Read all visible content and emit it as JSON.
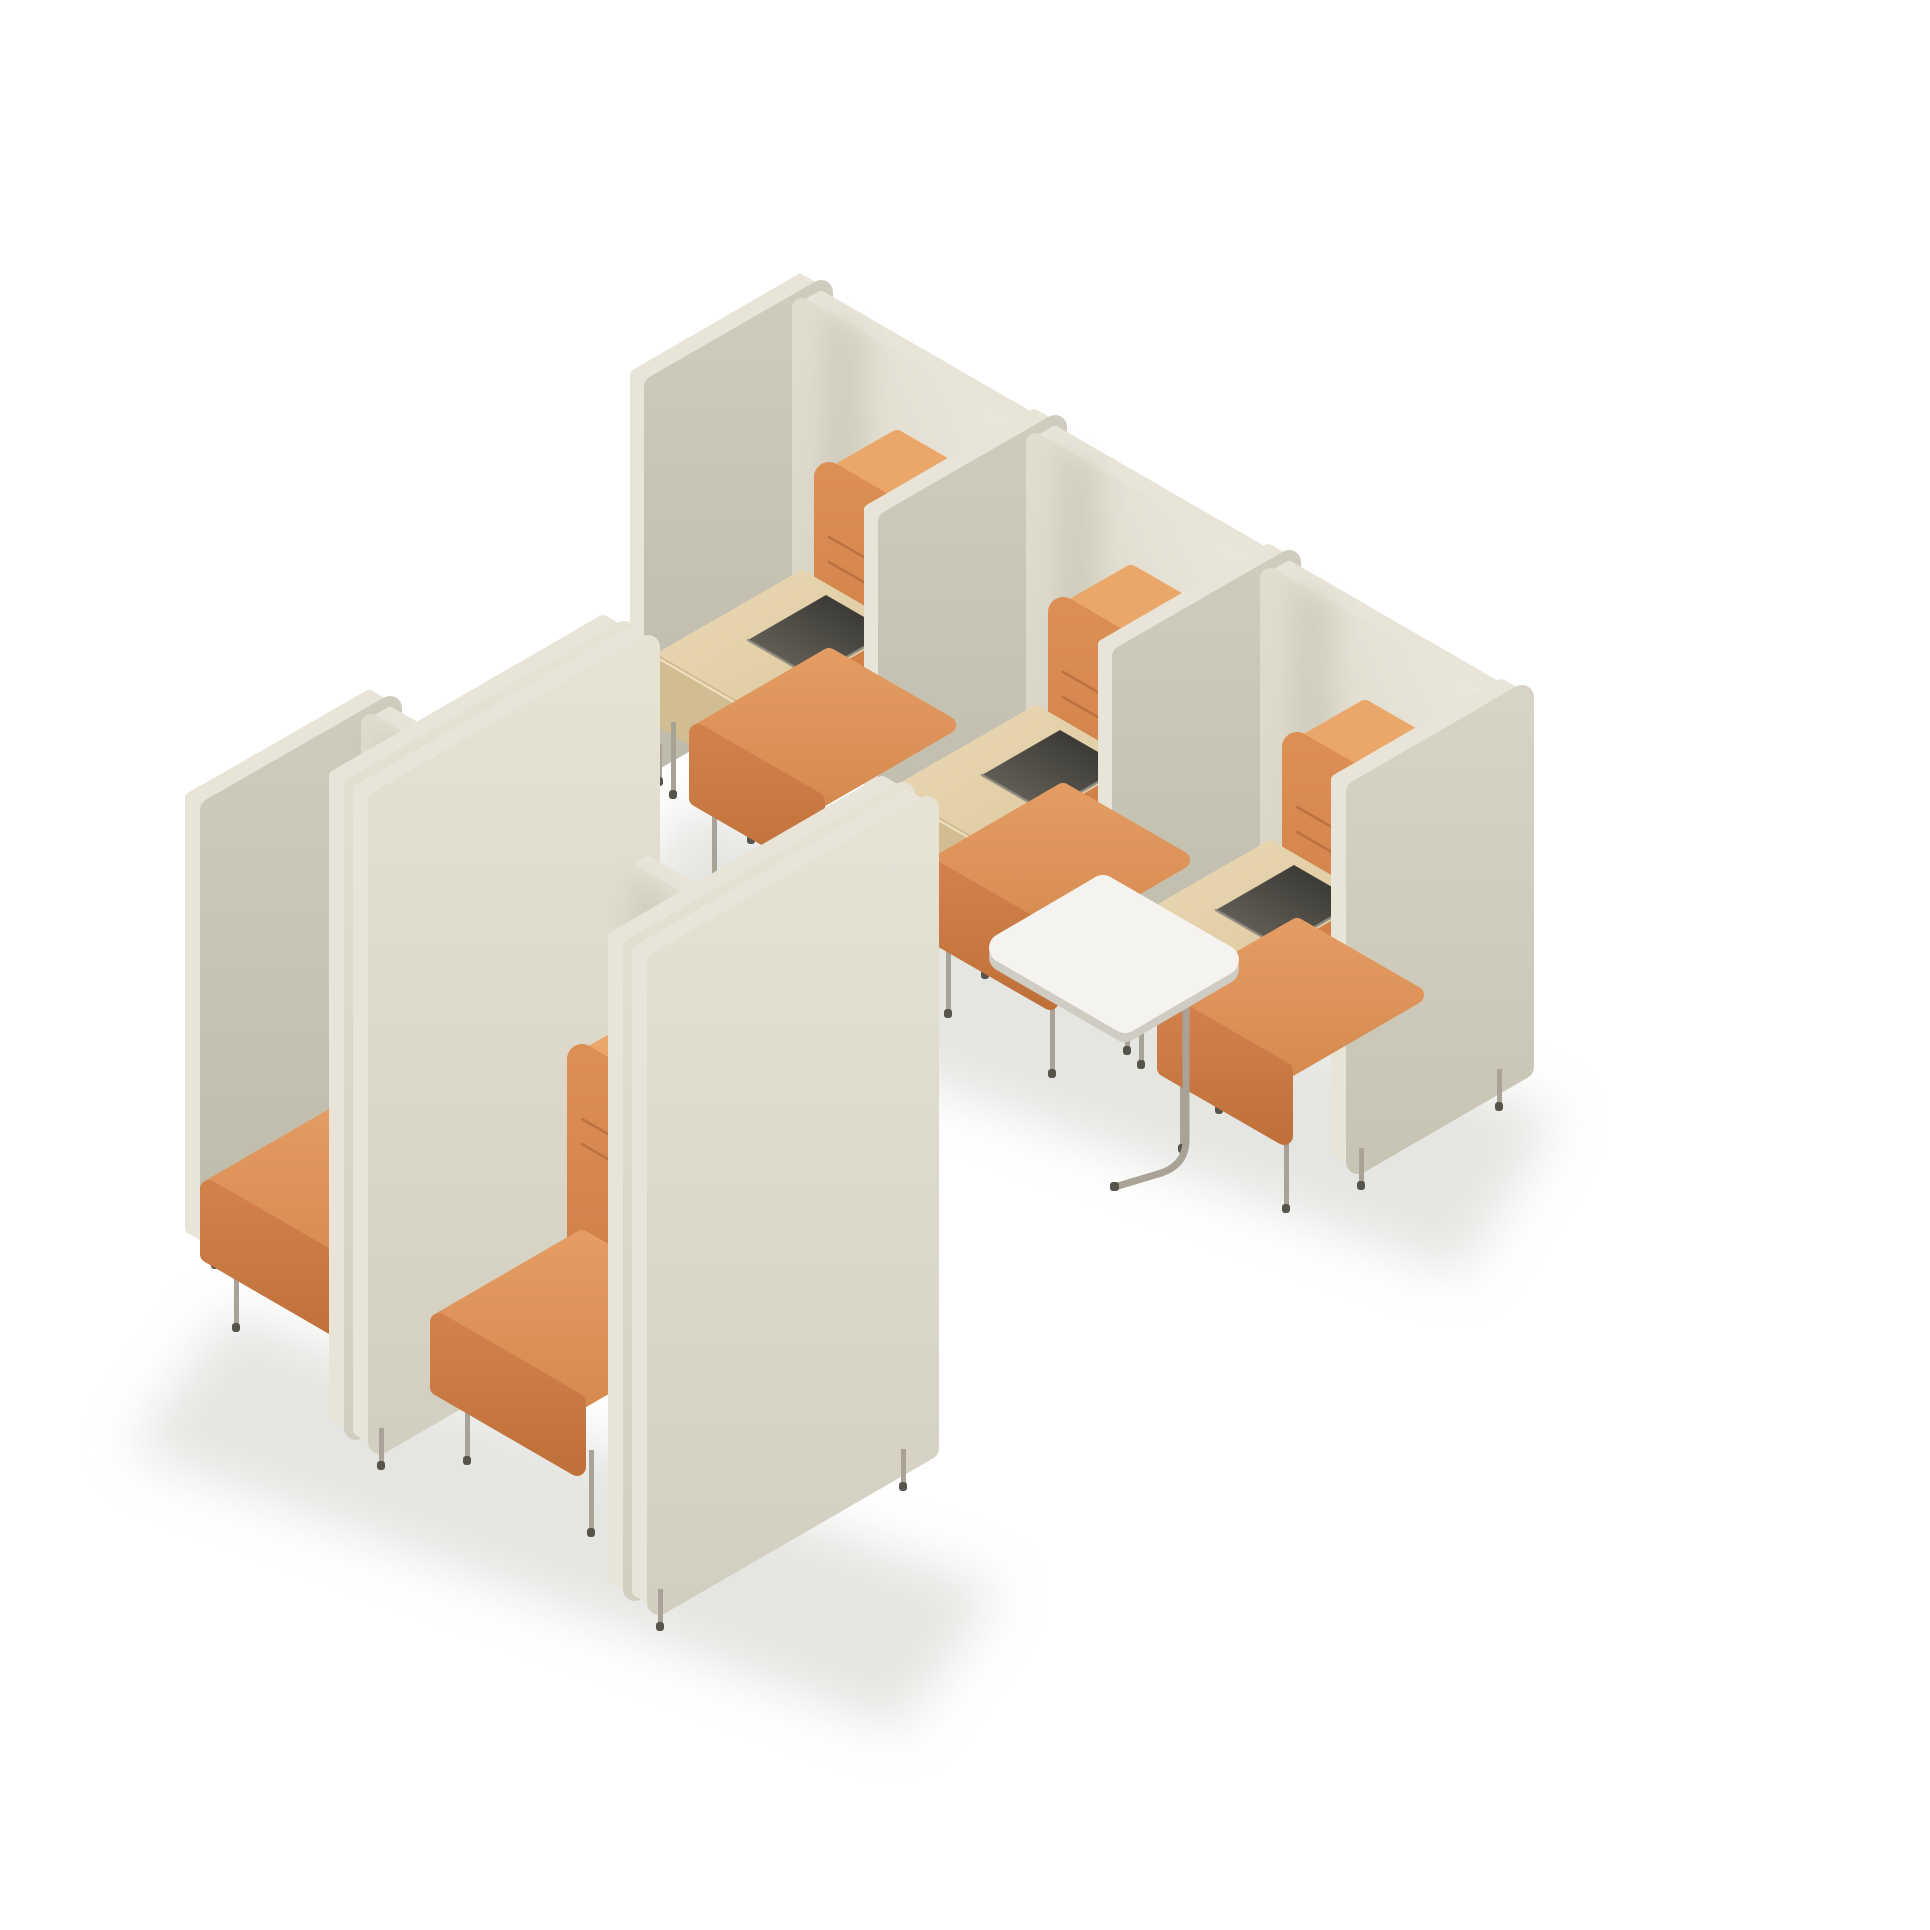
{
  "canvas": {
    "width": 1930,
    "height": 1930,
    "background": "#ffffff"
  },
  "scene": {
    "type": "isometric 3D product render",
    "subject": "modular acoustic privacy seating booths with high screens",
    "floor": "white studio background with soft cast shadows",
    "groups": [
      {
        "id": "booth-row-top-right",
        "booth_count": 3,
        "orientation": "row running to lower-right, seats opening toward lower-left",
        "booths": [
          {
            "id": "booth-1",
            "seat": "single orange fabric seat with channel-stitched backrest",
            "side_table": "light oak bench table",
            "storage_tray": "black recessed tray",
            "panels": "greige upholstered privacy panels with light welt edges",
            "legs": "thin tan metal legs"
          },
          {
            "id": "booth-2",
            "seat": "single orange fabric seat with channel-stitched backrest",
            "side_table": "light oak bench table",
            "storage_tray": "black recessed tray",
            "panels": "greige upholstered privacy panels with light welt edges",
            "legs": "thin tan metal legs"
          },
          {
            "id": "booth-3",
            "seat": "single orange fabric seat with channel-stitched backrest",
            "side_table": "light oak bench table",
            "storage_tray": "black recessed tray",
            "tablet_table": "white rounded-rectangle side table on metal sled base",
            "panels": "greige upholstered privacy panels with light welt edges",
            "legs": "thin tan metal legs"
          }
        ],
        "end_panel": "closing greige screen at right end of row"
      },
      {
        "id": "booth-row-bottom-left",
        "booth_count": 2,
        "orientation": "staggered row, seats opening toward lower-left, separated by tall partition screens",
        "booths": [
          {
            "id": "booth-4",
            "seat": "single orange fabric seat with channel-stitched backrest",
            "panels": "greige upholstered privacy panels with light welt edges",
            "legs": "thin tan metal legs"
          },
          {
            "id": "booth-5",
            "seat": "single orange fabric seat with channel-stitched backrest",
            "tablet_table": "white rounded-rectangle side table on metal sled base",
            "panels": "greige upholstered privacy panels with light welt edges",
            "legs": "thin tan metal legs"
          }
        ],
        "partition_screens": 4,
        "partition_style": "tall deep greige screens standing in back-to-back pairs with visible welt seams"
      }
    ]
  },
  "colors": {
    "bg": "#ffffff",
    "pipe": "#e8e5d8",
    "sideHi": "#d0ccbd",
    "sideLo": "#bfbbab",
    "backHi": "#eceadd",
    "backLo": "#d6d2c3",
    "extHi": "#e6e3d5",
    "extLo": "#d2cfc0",
    "endHi": "#d8d4c5",
    "endLo": "#c8c4b4",
    "woodHi": "#ead9b5",
    "woodLo": "#dcc89e",
    "woodFront": "#d2bd92",
    "woodEdge": "#f2e6c8",
    "trayDark": "#2e2d2a",
    "trayLight": "#6e6b61",
    "trayRim": "#8d8a80",
    "orangeBackrest": "#dc8f55",
    "orangeBackrestLo": "#cd7d45",
    "orangeTop": "#eba76a",
    "orangeTopLo": "#dd9257",
    "orangeCushHi": "#e49c62",
    "orangeCushLo": "#d68a50",
    "orangeFrontHi": "#d2814a",
    "orangeFrontLo": "#c0713a",
    "stitch": "#b56c3c",
    "tabletTop": "#f4f3ef",
    "tabletEdge": "#cfccc4",
    "leg": "#a8a396",
    "foot": "#57544c",
    "shadow": "#ddddd9",
    "corner": "#6b6550"
  }
}
